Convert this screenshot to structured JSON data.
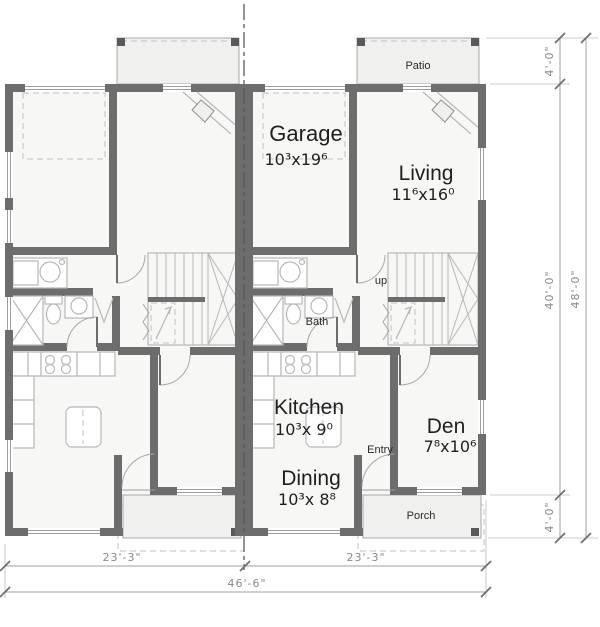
{
  "plan": {
    "title": "Duplex floor plan - main level",
    "rooms": {
      "garage": {
        "label": "Garage",
        "size": "10³x19⁶"
      },
      "living": {
        "label": "Living",
        "size": "11⁶x16⁰"
      },
      "kitchen": {
        "label": "Kitchen",
        "size": "10³x 9⁰"
      },
      "dining": {
        "label": "Dining",
        "size": "10³x 8⁸"
      },
      "den": {
        "label": "Den",
        "size": "7⁸x10⁶"
      },
      "bath": {
        "label": "Bath"
      },
      "entry": {
        "label": "Entry"
      },
      "stairs": {
        "label": "up"
      },
      "patio": {
        "label": "Patio"
      },
      "porch": {
        "label": "Porch"
      }
    },
    "dimensions": {
      "patio_depth": "4'-0\"",
      "main_depth": "40'-0\"",
      "porch_depth": "4'-0\"",
      "total_depth": "48'-0\"",
      "left_unit_width": "23'-3\"",
      "right_unit_width": "23'-3\"",
      "total_width": "46'-6\""
    },
    "colors": {
      "wall": "#6d6d6d",
      "interior_fill": "#f7f7f5",
      "slab_fill": "#f0f0ee",
      "fixture_stroke": "#b8b8b8",
      "dimension_text": "#8a8a8a",
      "label_text": "#1f1f1f"
    }
  }
}
